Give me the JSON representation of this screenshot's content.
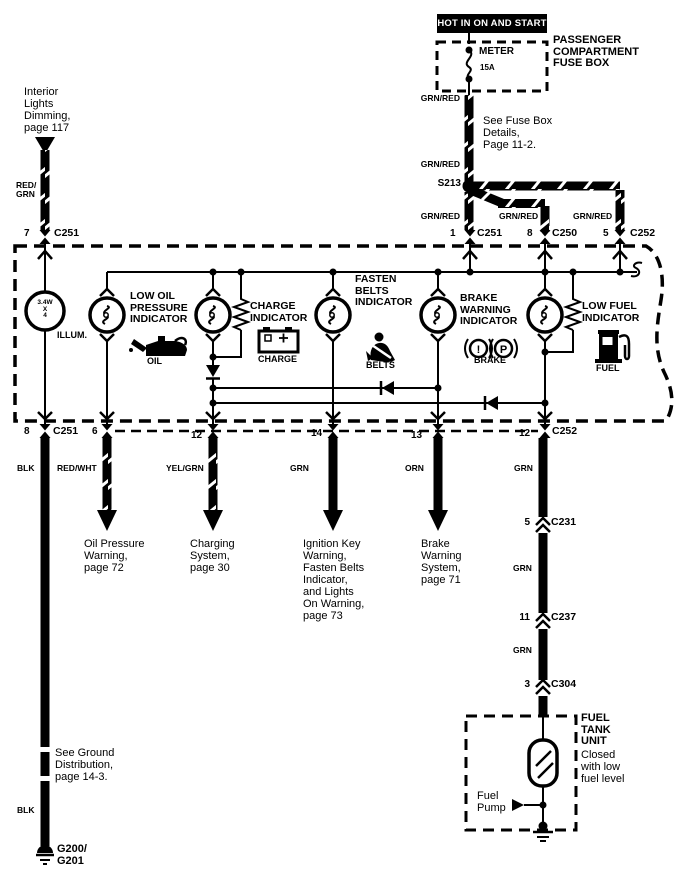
{
  "power": {
    "banner": "HOT IN ON AND START",
    "fusebox_name": "PASSENGER\nCOMPARTMENT\nFUSE BOX",
    "fuse_name": "METER",
    "fuse_rating": "15A",
    "note": "See Fuse Box\nDetails,\nPage 11-2.",
    "wire_upper": "GRN/RED",
    "wire_lower": "GRN/RED",
    "splice": "S213",
    "branch1": "GRN/RED",
    "branch2": "GRN/RED",
    "branch3": "GRN/RED",
    "pin1": "1",
    "conn1": "C251",
    "pin2": "8",
    "conn2": "C250",
    "pin3": "5",
    "conn3": "C252"
  },
  "interior": {
    "ref": "Interior\nLights\nDimming,\npage 117",
    "wire": "RED/\nGRN",
    "pin": "7",
    "conn": "C251"
  },
  "cluster": {
    "illum_rating": "3.4W\nX\n4",
    "illum_label": "ILLUM.",
    "oil_title": "LOW OIL\nPRESSURE\nINDICATOR",
    "oil_icon_label": "OIL",
    "charge_title": "CHARGE\nINDICATOR",
    "charge_icon_label": "CHARGE",
    "belts_title": "FASTEN\nBELTS\nINDICATOR",
    "belts_icon_label": "BELTS",
    "brake_title": "BRAKE\nWARNING\nINDICATOR",
    "brake_icon_label": "BRAKE",
    "brake_sym1": "!",
    "brake_sym2": "P",
    "fuel_title": "LOW FUEL\nINDICATOR",
    "fuel_icon_label": "FUEL"
  },
  "pins_bottom": {
    "p8": "8",
    "p8_conn": "C251",
    "p6": "6",
    "p12a": "12",
    "p14": "14",
    "p13": "13",
    "p12b": "12",
    "p12b_conn": "C252"
  },
  "wires": {
    "blk1": "BLK",
    "redwht": "RED/WHT",
    "yelgrn": "YEL/GRN",
    "grn1": "GRN",
    "orn": "ORN",
    "grn2": "GRN",
    "grn_seg1": "GRN",
    "grn_seg2": "GRN",
    "blk2": "BLK"
  },
  "dests": {
    "oil": "Oil Pressure\nWarning,\npage 72",
    "charging": "Charging\nSystem,\npage 30",
    "ignition": "Ignition Key\nWarning,\nFasten Belts\nIndicator,\nand Lights\nOn Warning,\npage 73",
    "brake": "Brake\nWarning\nSystem,\npage 71"
  },
  "chain": {
    "c231_pin": "5",
    "c231": "C231",
    "c237_pin": "11",
    "c237": "C237",
    "c304_pin": "3",
    "c304": "C304"
  },
  "tank": {
    "title": "FUEL\nTANK\nUNIT",
    "subtitle": "Closed\nwith low\nfuel level",
    "pump": "Fuel\nPump"
  },
  "ground": {
    "note": "See Ground\nDistribution,\npage 14-3.",
    "id": "G200/\nG201"
  }
}
